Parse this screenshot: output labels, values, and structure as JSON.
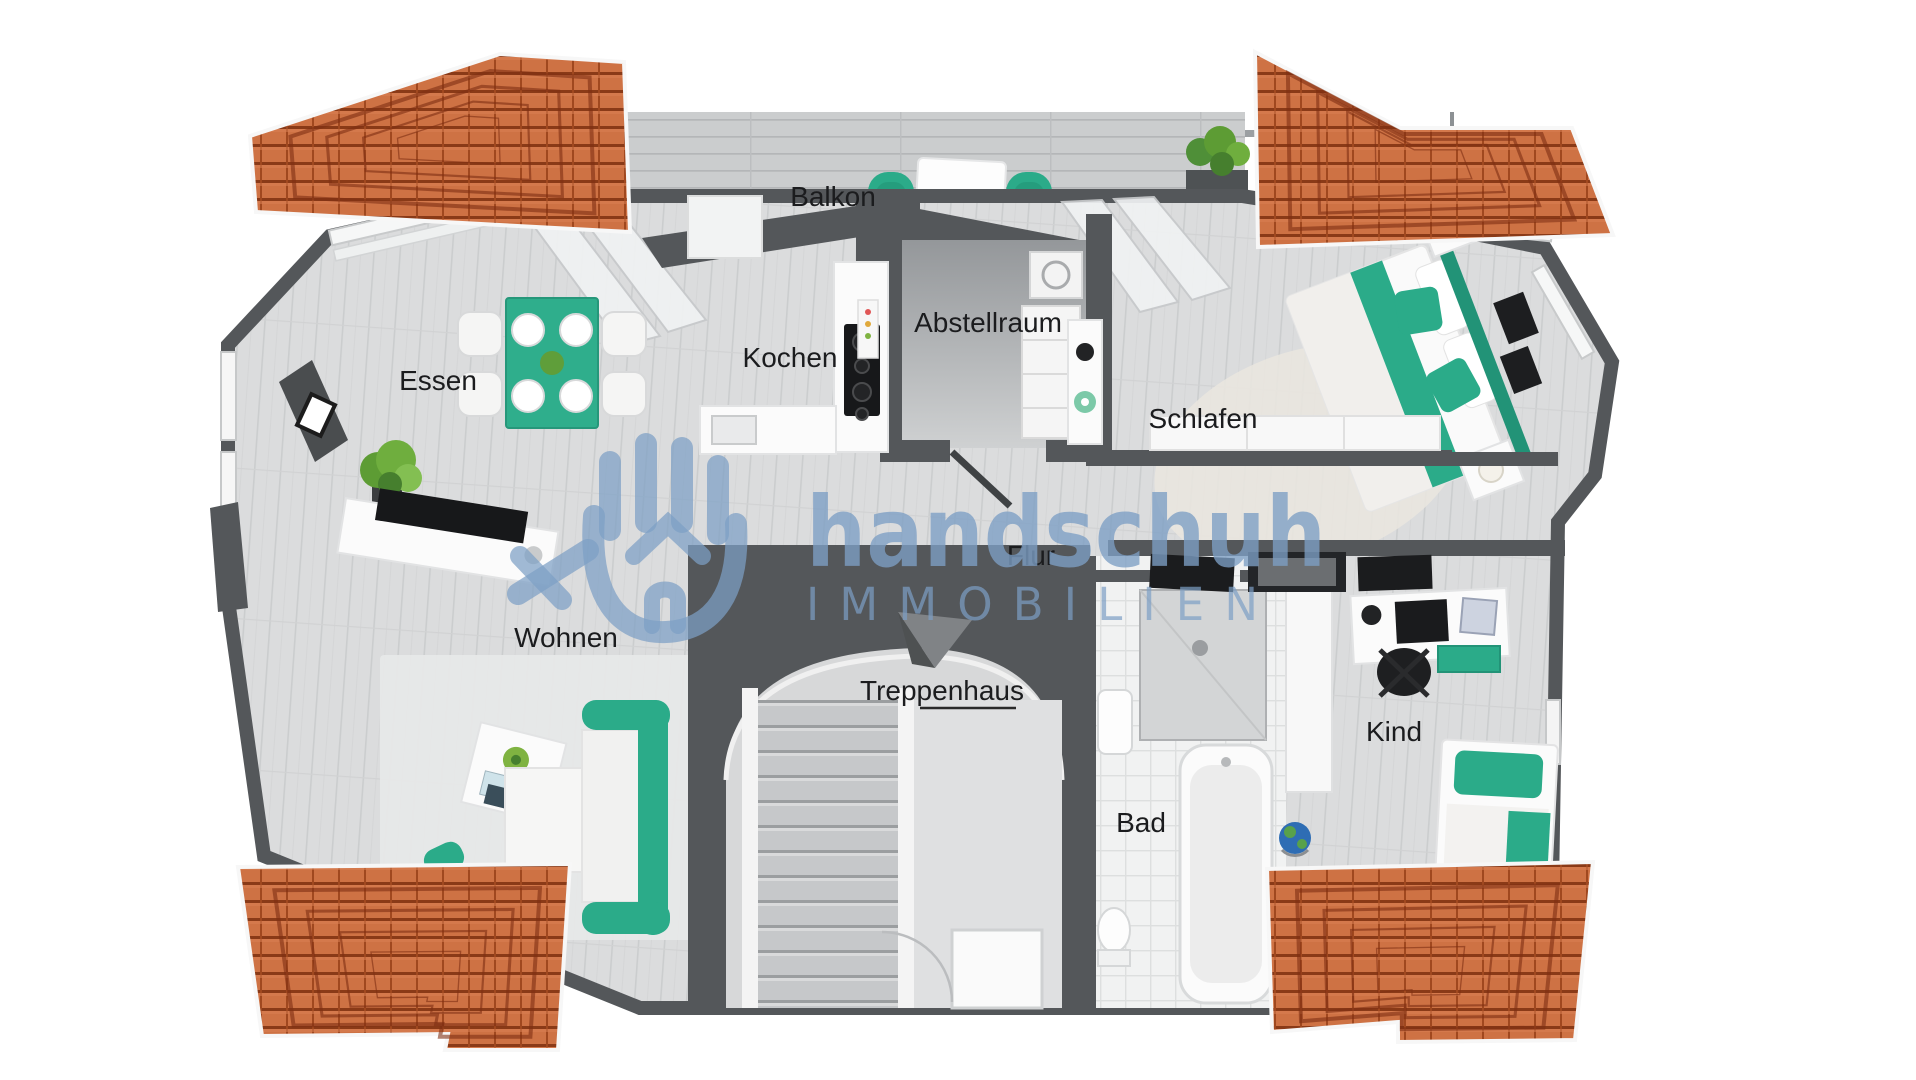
{
  "watermark": {
    "brand": "handschuh",
    "subtitle": "IMMOBILIEN",
    "logo": "hand-glove-house-icon",
    "color": "#7d9fc5"
  },
  "rooms": {
    "balkon": {
      "label": "Balkon"
    },
    "abstellraum": {
      "label": "Abstellraum"
    },
    "kochen": {
      "label": "Kochen"
    },
    "essen": {
      "label": "Essen"
    },
    "schlafen": {
      "label": "Schlafen"
    },
    "flur": {
      "label": "Flur"
    },
    "wohnen": {
      "label": "Wohnen"
    },
    "treppenhaus": {
      "label": "Treppenhaus"
    },
    "bad": {
      "label": "Bad"
    },
    "kind": {
      "label": "Kind"
    }
  },
  "palette": {
    "roof_tile": "#ce7244",
    "roof_ridge": "#7e2f12",
    "wall_dark": "#54575a",
    "floor": "#dbdcdd",
    "accent_green": "#2bab89",
    "deck": "#cbcdce",
    "watermark_blue": "#7d9fc5"
  }
}
